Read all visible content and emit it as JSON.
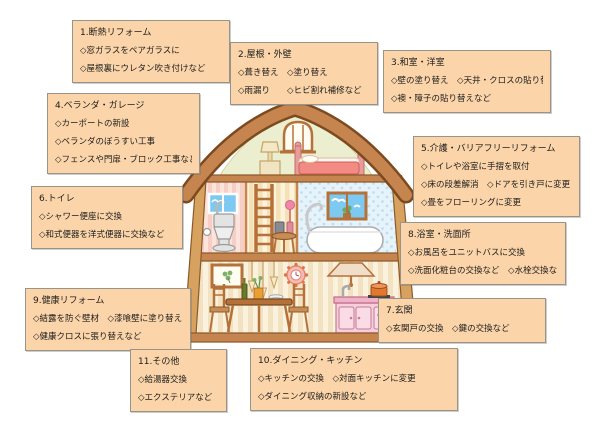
{
  "page": {
    "background": "#FFFFFF"
  },
  "palette": {
    "box_background": "#FBD5A9",
    "box_border": "#98948A",
    "box_text": "#1C1C1C",
    "roof_brown": "#C6854F",
    "roof_outline": "#7C4A21",
    "gable_green": "#EBEFCF",
    "toilet_room_pink": "#FCE4DC",
    "stair_room_cream": "#FCF3DA",
    "bathroom_blue": "#E7F3FA",
    "kitchen_pink": "#F6CFDC",
    "window_sky_blue": "#7EC9F1"
  },
  "boxes": [
    {
      "id": "1",
      "title": "1.断熱リフォーム",
      "lines": [
        "◇窓ガラスをペアガラスに",
        "◇屋根裏にウレタン吹き付けなど"
      ]
    },
    {
      "id": "2",
      "title": "2.屋根・外壁",
      "lines": [
        "◇葺き替え　◇塗り替え",
        "◇雨漏り　　◇ヒビ割れ補修など"
      ]
    },
    {
      "id": "3",
      "title": "3.和室・洋室",
      "lines": [
        "◇壁の塗り替え　◇天井・クロスの貼り替え",
        "◇襖・障子の貼り替えなど"
      ]
    },
    {
      "id": "4",
      "title": "4.ベランダ・ガレージ",
      "lines": [
        "◇カーポートの新設",
        "◇ベランダのぼうすい工事",
        "◇フェンスや門扉・ブロック工事など"
      ]
    },
    {
      "id": "5",
      "title": "5.介護・バリアフリーリフォーム",
      "lines": [
        "◇トイレや浴室に手摺を取付",
        "◇床の段差解消　◇ドアを引き戸に変更",
        "◇畳をフローリングに変更"
      ]
    },
    {
      "id": "6",
      "title": "6.トイレ",
      "lines": [
        "◇シャワー便座に交換",
        "◇和式便器を洋式便器に交換など"
      ]
    },
    {
      "id": "7",
      "title": "7.玄関",
      "lines": [
        "◇玄関戸の交換　◇鍵の交換など"
      ]
    },
    {
      "id": "8",
      "title": "8.浴室・洗面所",
      "lines": [
        "◇お風呂をユニットバスに交換",
        "◇洗面化粧台の交換など　◇水栓交換など"
      ]
    },
    {
      "id": "9",
      "title": "9.健康リフォーム",
      "lines": [
        "◇結露を防ぐ壁材　◇漆喰壁に塗り替え",
        "◇健康クロスに張り替えなど"
      ]
    },
    {
      "id": "10",
      "title": "10.ダイニング・キッチン",
      "lines": [
        "◇キッチンの交換　◇対面キッチンに変更",
        "◇ダイニング収納の新設など"
      ]
    },
    {
      "id": "11",
      "title": "11.その他",
      "lines": [
        "◇給湯器交換",
        "◇エクステリアなど"
      ]
    }
  ],
  "house": {
    "icons": [
      "roof",
      "attic-arch-window",
      "attic-bed",
      "attic-lamp",
      "toilet-window",
      "toilet-icon",
      "toilet-paper-icon",
      "ladder-icon",
      "flower-side-table",
      "bathroom-window",
      "bathtub-icon",
      "shower-pipe-icon",
      "picture-frame",
      "pendant-lights",
      "wall-clock",
      "range-hood",
      "dining-table",
      "dining-chairs",
      "wine-bottle",
      "flower-vase",
      "plates",
      "kitchen-counter",
      "faucet-icon",
      "cooking-pot-icon"
    ]
  }
}
